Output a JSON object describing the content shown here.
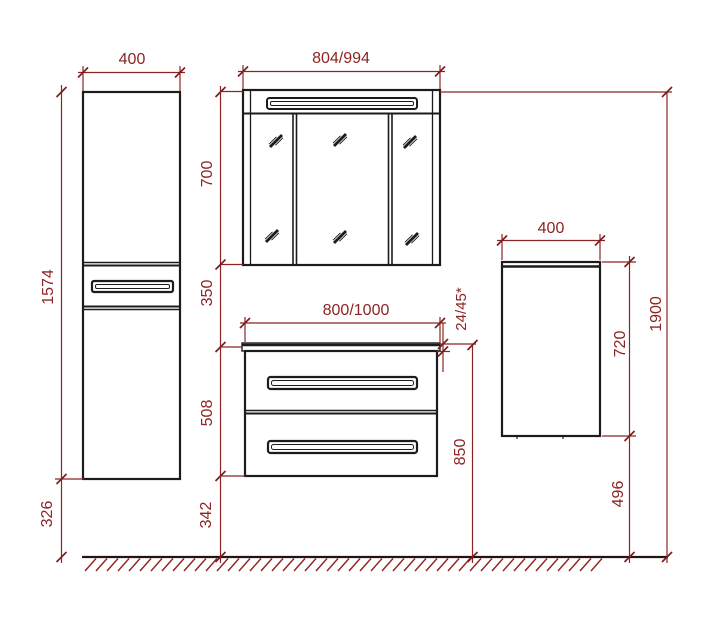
{
  "drawing_type": "bathroom-furniture-elevation",
  "colors": {
    "dimension_red": "#8e2323",
    "tick_red": "#7c1d1d",
    "furniture_black": "#1c1c1c"
  },
  "dimensions": {
    "tall_cabinet_width": "400",
    "tall_cabinet_height": "1574",
    "tall_cabinet_floor_gap": "326",
    "mirror_cabinet_width": "804/994",
    "mirror_cabinet_height": "700",
    "mirror_to_vanity_gap": "350",
    "vanity_width": "800/1000",
    "vanity_height": "508",
    "vanity_floor_gap": "342",
    "countertop_thickness": "24/45*",
    "vanity_top_height": "850",
    "side_cabinet_width": "400",
    "side_cabinet_height": "720",
    "side_cabinet_floor_gap": "496",
    "overall_height": "1900"
  }
}
